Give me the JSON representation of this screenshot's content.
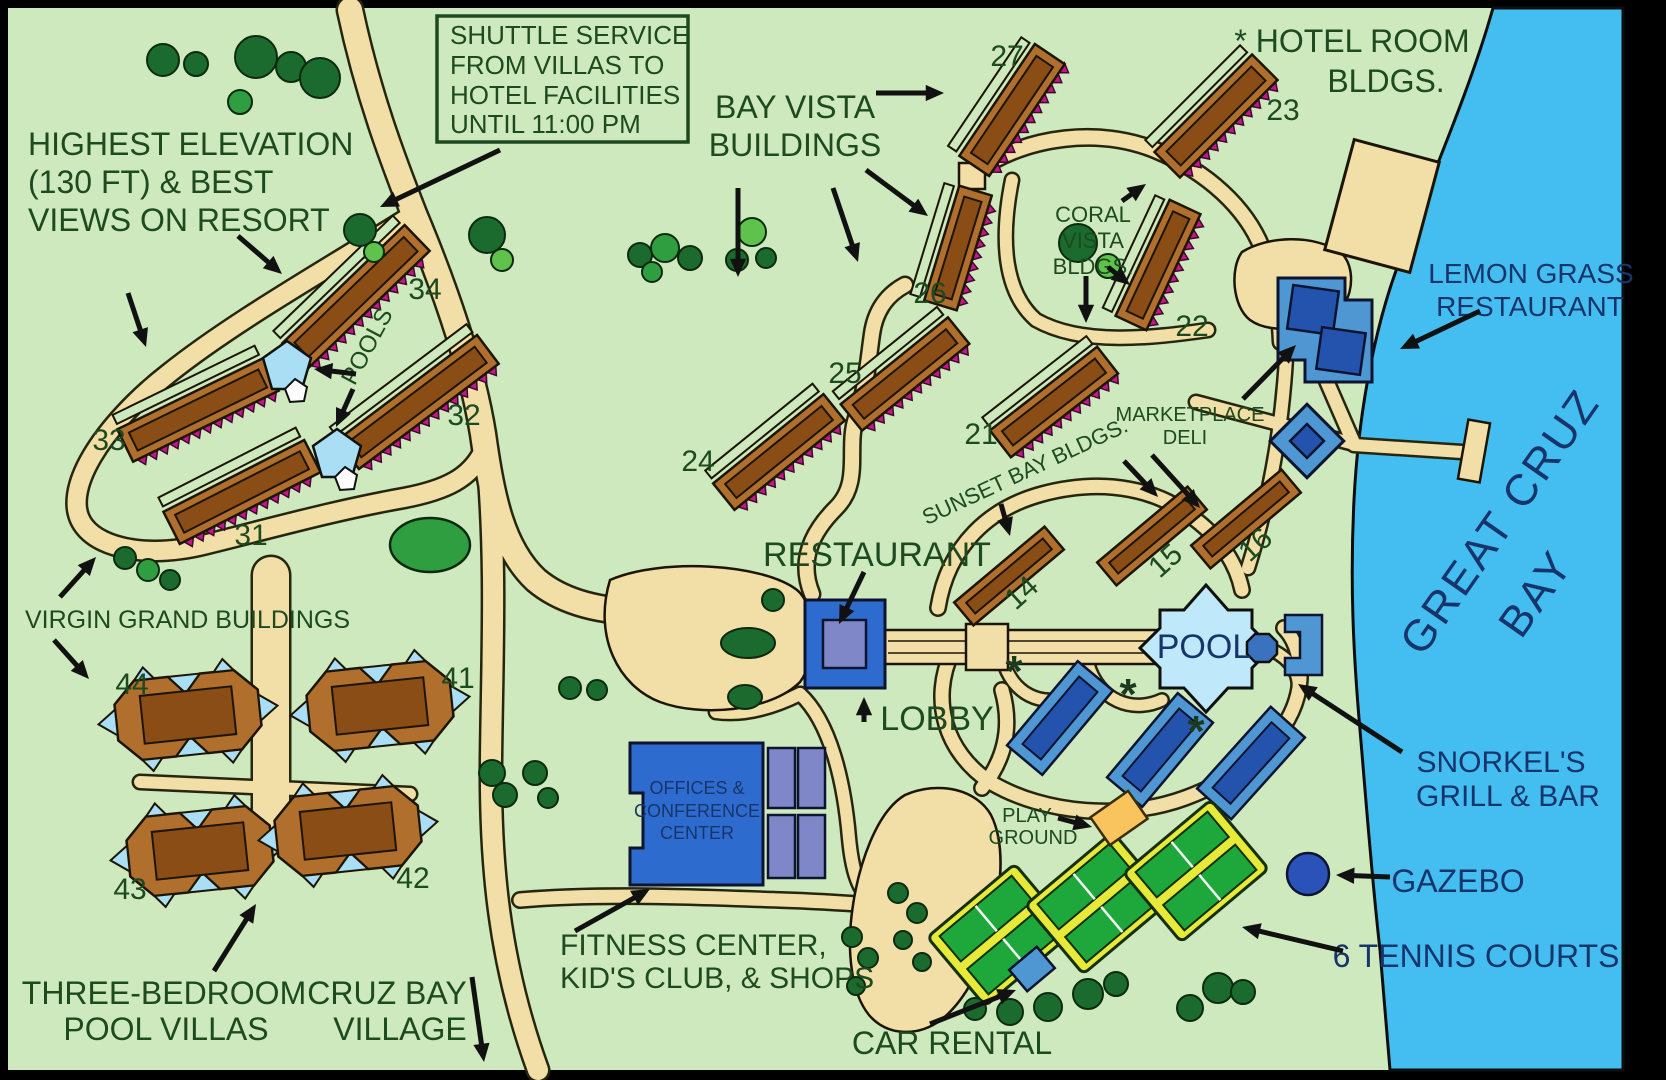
{
  "map_title": "Resort map of Great Cruz Bay",
  "labels": {
    "shuttle": {
      "l1": "SHUTTLE SERVICE",
      "l2": "FROM VILLAS TO",
      "l3": "HOTEL FACILITIES",
      "l4": "UNTIL 11:00 PM"
    },
    "elevation": {
      "l1": "HIGHEST ELEVATION",
      "l2": "(130 FT) & BEST",
      "l3": "VIEWS ON RESORT"
    },
    "bay_vista": {
      "l1": "BAY VISTA",
      "l2": "BUILDINGS"
    },
    "hotel_room": {
      "l1": "* HOTEL ROOM",
      "l2": "BLDGS."
    },
    "coral": {
      "l1": "CORAL",
      "l2": "VISTA",
      "l3": "BLDGS."
    },
    "marketplace": {
      "l1": "MARKETPLACE",
      "l2": "DELI"
    },
    "sunset": "SUNSET BAY BLDGS.",
    "restaurant": "RESTAURANT",
    "lobby": "LOBBY",
    "pool": "POOL",
    "pools": "POOLS",
    "virgin": "VIRGIN GRAND BUILDINGS",
    "offices": {
      "l1": "OFFICES &",
      "l2": "CONFERENCE",
      "l3": "CENTER"
    },
    "fitness": {
      "l1": "FITNESS CENTER,",
      "l2": "KID'S CLUB, & SHOPS"
    },
    "three_br": {
      "l1": "THREE-BEDROOM",
      "l2": "POOL VILLAS"
    },
    "cruz": {
      "l1": "CRUZ BAY",
      "l2": "VILLAGE"
    },
    "car": "CAR RENTAL",
    "play": {
      "l1": "PLAY",
      "l2": "GROUND"
    },
    "tennis": "6 TENNIS COURTS",
    "gazebo": "GAZEBO",
    "snorkel": {
      "l1": "SNORKEL'S",
      "l2": "GRILL & BAR"
    },
    "lemon": {
      "l1": "LEMON GRASS",
      "l2": "RESTAURANT"
    },
    "bay": {
      "l1": "GREAT CRUZ",
      "l2": "BAY"
    }
  },
  "building_numbers": [
    {
      "n": "27",
      "x": 1007,
      "y": 66,
      "rot": 0
    },
    {
      "n": "23",
      "x": 1283,
      "y": 120,
      "rot": 0
    },
    {
      "n": "26",
      "x": 930,
      "y": 303,
      "rot": 0
    },
    {
      "n": "22",
      "x": 1192,
      "y": 336,
      "rot": 0
    },
    {
      "n": "25",
      "x": 845,
      "y": 383,
      "rot": 0
    },
    {
      "n": "21",
      "x": 981,
      "y": 444,
      "rot": 0
    },
    {
      "n": "24",
      "x": 698,
      "y": 471,
      "rot": 0
    },
    {
      "n": "34",
      "x": 425,
      "y": 299,
      "rot": 0
    },
    {
      "n": "32",
      "x": 464,
      "y": 425,
      "rot": 0
    },
    {
      "n": "33",
      "x": 109,
      "y": 450,
      "rot": 0
    },
    {
      "n": "31",
      "x": 251,
      "y": 545,
      "rot": 0
    },
    {
      "n": "44",
      "x": 132,
      "y": 694,
      "rot": 0
    },
    {
      "n": "41",
      "x": 458,
      "y": 688,
      "rot": 0
    },
    {
      "n": "43",
      "x": 130,
      "y": 899,
      "rot": 0
    },
    {
      "n": "42",
      "x": 413,
      "y": 888,
      "rot": 0
    },
    {
      "n": "14",
      "x": 1028,
      "y": 600,
      "rot": -42
    },
    {
      "n": "15",
      "x": 1172,
      "y": 568,
      "rot": -42
    },
    {
      "n": "16",
      "x": 1262,
      "y": 552,
      "rot": -42
    }
  ],
  "asterisks": [
    {
      "x": 1014,
      "y": 686
    },
    {
      "x": 1128,
      "y": 709
    },
    {
      "x": 1196,
      "y": 746
    }
  ],
  "colors": {
    "land": "#cde9bd",
    "water": "#44bdf0",
    "road": "#f2dfa8",
    "road_edge": "#26260f",
    "building_brown": "#b06f2d",
    "building_brown_dark": "#8a4d15",
    "roof_zigzag_magenta": "#c2188c",
    "hotel_blue": "#4f97d2",
    "hotel_blue_dark": "#2453ae",
    "restaurant_blue": "#2e6bce",
    "restaurant_inner_lavender": "#8087c8",
    "pool_blue": "#bfe9fb",
    "small_pool_blue": "#a9def5",
    "tennis_green": "#1ea83c",
    "tennis_yellow": "#e8ea3a",
    "playground_orange": "#f9c35e",
    "gazebo_blue": "#2a52b8",
    "tree_dark": "#1b6b2f",
    "tree_mid": "#2f9e41",
    "tree_light": "#5fc24c",
    "text_green": "#1d4a1f",
    "text_navy": "#17356b"
  }
}
